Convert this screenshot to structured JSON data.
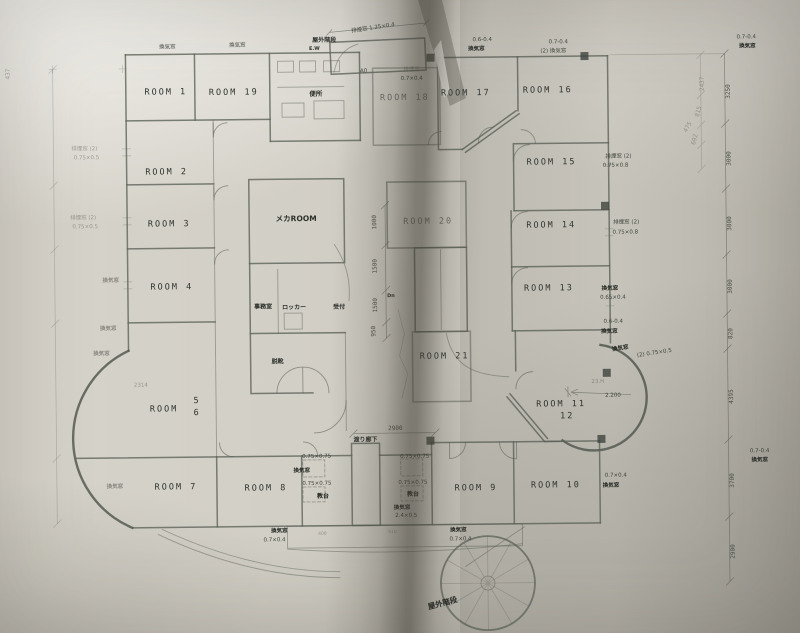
{
  "document": {
    "kind": "scanned architectural floor plan",
    "language": "Japanese"
  },
  "colors": {
    "paper": "#cfccc3",
    "line": "#5e645a",
    "text": "#2f342e",
    "fold_shadow": "#6f6c63"
  },
  "plan": {
    "rooms": [
      {
        "t": "ROOM 1",
        "x": 168,
        "y": 92
      },
      {
        "t": "ROOM 19",
        "x": 236,
        "y": 93
      },
      {
        "t": "ROOM 2",
        "x": 168,
        "y": 172
      },
      {
        "t": "ROOM 3",
        "x": 170,
        "y": 224
      },
      {
        "t": "ROOM 4",
        "x": 172,
        "y": 287
      },
      {
        "t": "ROOM",
        "x": 163,
        "y": 409
      },
      {
        "t": "5",
        "x": 196,
        "y": 401
      },
      {
        "t": "6",
        "x": 196,
        "y": 413
      },
      {
        "t": "ROOM 7",
        "x": 174,
        "y": 487
      },
      {
        "t": "ROOM 8",
        "x": 264,
        "y": 489
      },
      {
        "t": "ROOM 9",
        "x": 474,
        "y": 491
      },
      {
        "t": "ROOM 10",
        "x": 554,
        "y": 489
      },
      {
        "t": "ROOM 11",
        "x": 560,
        "y": 408
      },
      {
        "t": "12",
        "x": 566,
        "y": 420
      },
      {
        "t": "ROOM 13",
        "x": 549,
        "y": 292
      },
      {
        "t": "ROOM 14",
        "x": 552,
        "y": 229
      },
      {
        "t": "ROOM 15",
        "x": 553,
        "y": 166
      },
      {
        "t": "ROOM 16",
        "x": 550,
        "y": 94
      },
      {
        "t": "ROOM 17",
        "x": 468,
        "y": 96
      },
      {
        "t": "ROOM 18",
        "x": 407,
        "y": 100,
        "dim": 1
      },
      {
        "t": "ROOM 20",
        "x": 429,
        "y": 224,
        "dim": 1
      },
      {
        "t": "ROOM 21",
        "x": 444,
        "y": 359
      }
    ],
    "spaces": [
      {
        "t": "便所",
        "x": 318,
        "y": 95
      },
      {
        "t": "メカROOM",
        "x": 297,
        "y": 220,
        "s": 7.5
      },
      {
        "t": "事務室",
        "x": 263,
        "y": 307,
        "s": 6
      },
      {
        "t": "ロッカー",
        "x": 294,
        "y": 308,
        "s": 6
      },
      {
        "t": "受付",
        "x": 339,
        "y": 308,
        "s": 6
      },
      {
        "t": "脱靴",
        "x": 277,
        "y": 362,
        "s": 6
      },
      {
        "t": "渡り廊下",
        "x": 364,
        "y": 441,
        "s": 6
      },
      {
        "t": "教台",
        "x": 321,
        "y": 497,
        "b": 1,
        "s": 6
      },
      {
        "t": "教台",
        "x": 411,
        "y": 496,
        "b": 1,
        "s": 6
      },
      {
        "t": "屋外階段",
        "x": 327,
        "y": 41,
        "s": 6
      },
      {
        "t": "E.W",
        "x": 317,
        "y": 49,
        "s": 5
      },
      {
        "t": "屋外階段",
        "x": 440,
        "y": 606,
        "b": 1,
        "r": -14,
        "s": 7.5
      },
      {
        "t": "Dn",
        "x": 391,
        "y": 297,
        "s": 5
      }
    ],
    "annotations": [
      {
        "t": "排煙窓 1.25×0.4",
        "x": 376,
        "y": 29,
        "r": -8
      },
      {
        "t": "換気窓",
        "x": 170,
        "y": 46
      },
      {
        "t": "換気窓",
        "x": 240,
        "y": 45
      },
      {
        "t": "A0",
        "x": 366,
        "y": 72
      },
      {
        "t": "排煙窓",
        "x": 414,
        "y": 71,
        "f": 1
      },
      {
        "t": "0.7×0.4",
        "x": 414,
        "y": 80
      },
      {
        "t": "0.6-0.4",
        "x": 485,
        "y": 42
      },
      {
        "t": "換気窓",
        "x": 479,
        "y": 51,
        "b": 1
      },
      {
        "t": "0.7-0.4",
        "x": 561,
        "y": 45
      },
      {
        "t": "(2) 換気窓",
        "x": 556,
        "y": 54
      },
      {
        "t": "0.7-0.4",
        "x": 749,
        "y": 42
      },
      {
        "t": "換気窓",
        "x": 750,
        "y": 51,
        "b": 1
      },
      {
        "t": "排煙窓 (2)",
        "x": 620,
        "y": 160
      },
      {
        "t": "0.75×0.8",
        "x": 617,
        "y": 169
      },
      {
        "t": "排煙窓 (2)",
        "x": 627,
        "y": 226
      },
      {
        "t": "0.75×0.8",
        "x": 626,
        "y": 236
      },
      {
        "t": "換気窓",
        "x": 610,
        "y": 292,
        "b": 1
      },
      {
        "t": "0.65×0.4",
        "x": 613,
        "y": 301
      },
      {
        "t": "0.6-0.4",
        "x": 613,
        "y": 325
      },
      {
        "t": "換気窓",
        "x": 609,
        "y": 335,
        "b": 1
      },
      {
        "t": "換気窓",
        "x": 620,
        "y": 352,
        "b": 1,
        "r": -8
      },
      {
        "t": "(2) 0.75×0.5",
        "x": 654,
        "y": 357,
        "r": -8
      },
      {
        "t": "23.H",
        "x": 597,
        "y": 385,
        "f": 1
      },
      {
        "t": "2.200",
        "x": 612,
        "y": 399
      },
      {
        "t": "0.7×0.4",
        "x": 614,
        "y": 479
      },
      {
        "t": "換気窓",
        "x": 609,
        "y": 489,
        "b": 1
      },
      {
        "t": "0.7-0.4",
        "x": 758,
        "y": 456
      },
      {
        "t": "換気窓",
        "x": 758,
        "y": 465,
        "b": 1
      },
      {
        "t": "0.75×0.75",
        "x": 315,
        "y": 457
      },
      {
        "t": "換気窓",
        "x": 300,
        "y": 471,
        "b": 1
      },
      {
        "t": "0.75×0.75",
        "x": 315,
        "y": 484
      },
      {
        "t": "0.75×0.75",
        "x": 413,
        "y": 458
      },
      {
        "t": "0.75×0.75",
        "x": 411,
        "y": 484
      },
      {
        "t": "換気窓",
        "x": 400,
        "y": 509,
        "b": 1
      },
      {
        "t": "2.4×0.5",
        "x": 404,
        "y": 517
      },
      {
        "t": "換気窓",
        "x": 277,
        "y": 531,
        "b": 1
      },
      {
        "t": "0.7×0.4",
        "x": 272,
        "y": 540
      },
      {
        "t": "換気窓",
        "x": 456,
        "y": 532,
        "b": 1
      },
      {
        "t": "0.7×0.4",
        "x": 458,
        "y": 541
      },
      {
        "t": "排煙窓 (2)",
        "x": 86,
        "y": 147,
        "f": 1
      },
      {
        "t": "0.75×0.5",
        "x": 88,
        "y": 156,
        "f": 1
      },
      {
        "t": "排煙窓 (2)",
        "x": 84,
        "y": 216,
        "f": 1
      },
      {
        "t": "0.75×0.5",
        "x": 86,
        "y": 225,
        "f": 1
      },
      {
        "t": "換気窓",
        "x": 111,
        "y": 279,
        "f": 1,
        "b": 1
      },
      {
        "t": "換気窓",
        "x": 108,
        "y": 327,
        "f": 1,
        "b": 1
      },
      {
        "t": "換気窓",
        "x": 101,
        "y": 352,
        "f": 1,
        "b": 1
      },
      {
        "t": "換気窓",
        "x": 113,
        "y": 485,
        "f": 1,
        "b": 1
      },
      {
        "t": "2314",
        "x": 140,
        "y": 384,
        "f": 1
      },
      {
        "t": "408",
        "x": 320,
        "y": 534,
        "f": 1,
        "s": 4.5
      },
      {
        "t": "510",
        "x": 390,
        "y": 533,
        "f": 1,
        "s": 4.5
      }
    ],
    "dims": [
      {
        "t": "1000",
        "x": 377,
        "y": 222,
        "r": -90
      },
      {
        "t": "1500",
        "x": 377,
        "y": 266,
        "r": -90
      },
      {
        "t": "1500",
        "x": 377,
        "y": 305,
        "r": -90
      },
      {
        "t": "950",
        "x": 375,
        "y": 331,
        "r": -90
      },
      {
        "t": "2900",
        "x": 394,
        "y": 430
      },
      {
        "t": "3250",
        "x": 732,
        "y": 95,
        "r": -90
      },
      {
        "t": "3000",
        "x": 732,
        "y": 162,
        "r": -90
      },
      {
        "t": "3000",
        "x": 732,
        "y": 227,
        "r": -90
      },
      {
        "t": "3000",
        "x": 732,
        "y": 290,
        "r": -90
      },
      {
        "t": "820",
        "x": 732,
        "y": 337,
        "r": -90
      },
      {
        "t": "4395",
        "x": 732,
        "y": 400,
        "r": -90
      },
      {
        "t": "3700",
        "x": 732,
        "y": 484,
        "r": -90
      },
      {
        "t": "2900",
        "x": 732,
        "y": 555,
        "r": -90
      },
      {
        "t": "2437",
        "x": 706,
        "y": 87,
        "r": -90,
        "f": 1
      },
      {
        "t": "815",
        "x": 702,
        "y": 115,
        "r": -75,
        "f": 1
      },
      {
        "t": "692",
        "x": 698,
        "y": 143,
        "r": -75,
        "f": 1
      },
      {
        "t": "475",
        "x": 691,
        "y": 131,
        "r": -60,
        "f": 1
      },
      {
        "t": "437",
        "x": 12,
        "y": 70,
        "r": -90,
        "f": 1
      }
    ]
  }
}
